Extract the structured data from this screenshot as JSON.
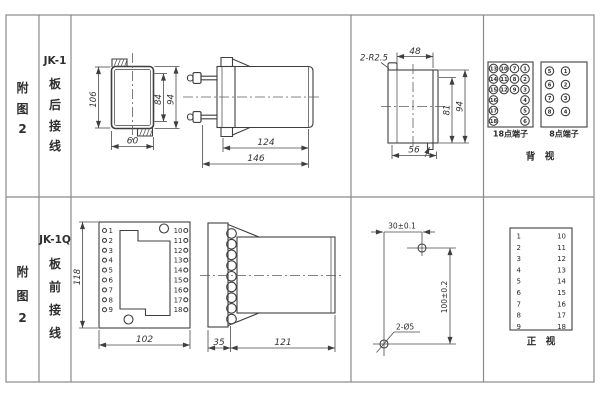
{
  "sidebar": {
    "top_figure": [
      "附",
      "图",
      "2"
    ],
    "top_model": "JK-1",
    "top_wiring": [
      "板",
      "后",
      "接",
      "线"
    ],
    "bottom_figure": [
      "附",
      "图",
      "2"
    ],
    "bottom_model": "JK-1Q",
    "bottom_wiring": [
      "板",
      "前",
      "接",
      "线"
    ]
  },
  "rear": {
    "front_view": {
      "h106": "106",
      "h84": "84",
      "h94": "94",
      "w60": "60"
    },
    "side_view": {
      "d124": "124",
      "d146": "146"
    },
    "cutout": {
      "r_label": "2-R2.5",
      "w48": "48",
      "h81": "81",
      "h94": "94",
      "w56": "56"
    },
    "terminals": {
      "t18": [
        "13",
        "10",
        "7",
        "1",
        "14",
        "11",
        "8",
        "2",
        "15",
        "12",
        "9",
        "3",
        "16",
        "4",
        "17",
        "5",
        "18",
        "6"
      ],
      "t8": [
        "5",
        "1",
        "6",
        "2",
        "7",
        "3",
        "8",
        "4"
      ],
      "t18_label": "18点端子",
      "t8_label": "8点端子",
      "view_label": "背　视"
    }
  },
  "front": {
    "front_view": {
      "h118": "118",
      "w102": "102",
      "left": [
        "1",
        "2",
        "3",
        "4",
        "5",
        "6",
        "7",
        "8",
        "9"
      ],
      "right": [
        "10",
        "11",
        "12",
        "13",
        "14",
        "15",
        "16",
        "17",
        "18"
      ]
    },
    "side_view": {
      "d35": "35",
      "d121": "121"
    },
    "drill": {
      "dx": "30±0.1",
      "dy": "100±0.2",
      "holes": "2-Ø5"
    },
    "table": {
      "left": [
        "1",
        "2",
        "3",
        "4",
        "5",
        "6",
        "7",
        "8",
        "9"
      ],
      "right": [
        "10",
        "11",
        "12",
        "13",
        "14",
        "15",
        "16",
        "17",
        "18"
      ],
      "view_label": "正　视"
    }
  }
}
